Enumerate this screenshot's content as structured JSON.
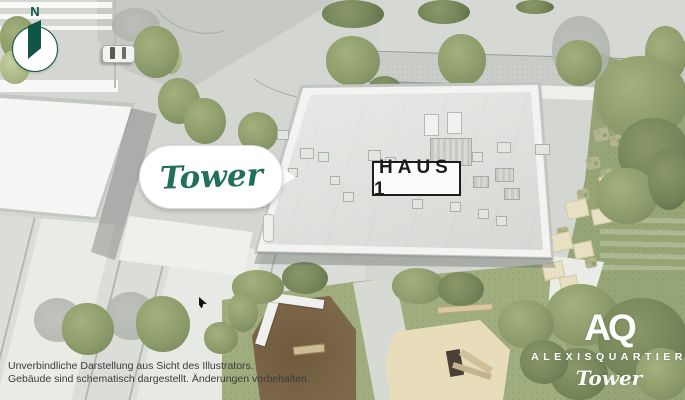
{
  "title": "Alexisquartier Tower – Lageplan",
  "compass": {
    "label": "N"
  },
  "callout": {
    "label": "Tower"
  },
  "building": {
    "label": "HAUS 1"
  },
  "disclaimer": {
    "line1": "Unverbindliche Darstellung aus Sicht des Illustrators.",
    "line2": "Gebäude sind schematisch dargestellt. Änderungen vorbehalten."
  },
  "logo": {
    "monogram": "AQ",
    "wordmark": "ALEXISQUARTIER",
    "claim": "Tower"
  },
  "colors": {
    "brand_green": "#1f6f5b",
    "compass_green": "#12564a",
    "label_ink": "#1d1d1b",
    "disclaimer_ink": "#3b3b3b",
    "logo_white": "#ffffff",
    "roof_gray": "#e0e2de",
    "lawn_green": "#96a575"
  }
}
